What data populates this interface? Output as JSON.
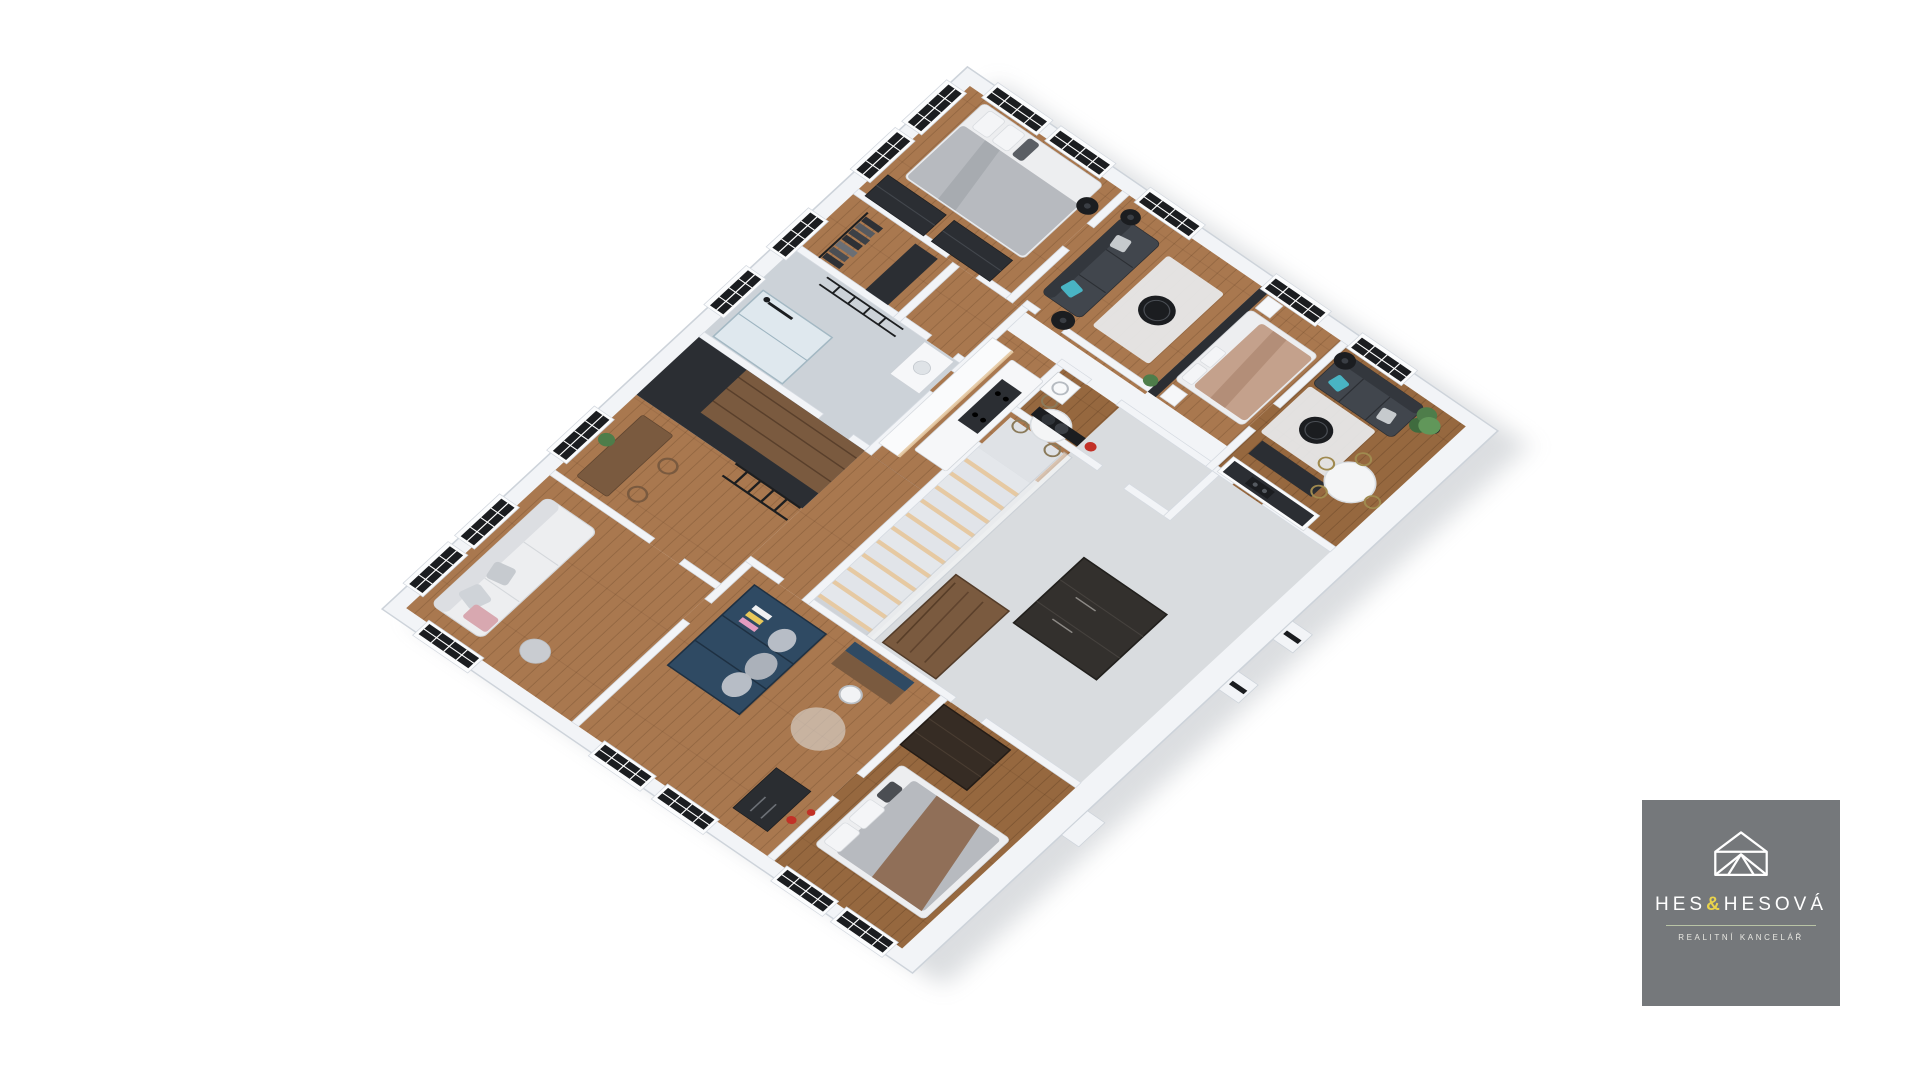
{
  "logo": {
    "name_left": "HES",
    "ampersand": "&",
    "name_right": "HESOVÁ",
    "subtitle": "REALITNÍ KANCELÁŘ"
  },
  "palette": {
    "canvas": "#FFFFFF",
    "wall_top": "#F2F4F7",
    "wall_edge": "#D3D8DF",
    "wood": "#A9784F",
    "wood_dark": "#96683F",
    "wood_panel": "#7A5A3F",
    "concrete": "#D9DCDF",
    "tile": "#CCD2D8",
    "charcoal": "#2B2E33",
    "near_black": "#1B1D20",
    "dark_brown": "#362C24",
    "petrol_blue": "#2F4A63",
    "teal": "#49B4C4",
    "silver": "#B7BABF",
    "blush": "#C4A18C",
    "white_furniture": "#EDEEF0",
    "rug": "#E9EBEE",
    "plant_green": "#4E7D4A",
    "step_light": "#E6C9A2",
    "shadow": "#9AA0A8",
    "logo_gray": "#75787B",
    "logo_yellow": "#E9D34B",
    "logo_sage": "#B9C4A6",
    "logo_text": "#FFFFFF",
    "accent_red": "#C23127"
  }
}
